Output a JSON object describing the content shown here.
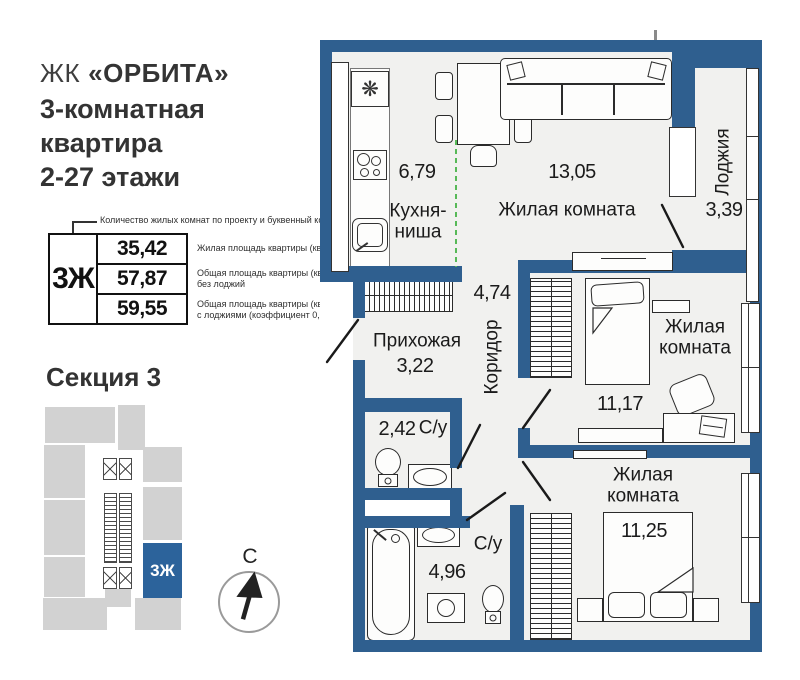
{
  "header": {
    "complex_prefix": "ЖК",
    "complex_name": "«ОРБИТА»",
    "apartment_title": "3-комнатная\nквартира\n2-27 этажи"
  },
  "info_table": {
    "callout": "Количество жилых комнат по проекту и буквенный код",
    "code": "3Ж",
    "rows": [
      {
        "value": "35,42",
        "desc": "Жилая площадь квартиры (кв.м)"
      },
      {
        "value": "57,87",
        "desc": "Общая площадь квартиры (кв.м)\nбез лоджий"
      },
      {
        "value": "59,55",
        "desc": "Общая площадь квартиры (кв.м)\nс лоджиями (коэффициент 0,5)"
      }
    ]
  },
  "section": {
    "title": "Секция 3",
    "highlight_label": "3Ж"
  },
  "compass": {
    "north_label": "С"
  },
  "plan": {
    "rooms": [
      {
        "name": "Кухня-\nниша",
        "area": "6,79"
      },
      {
        "name": "Жилая комната",
        "area": "13,05"
      },
      {
        "name": "Лоджия",
        "area": "3,39"
      },
      {
        "name": "Прихожая",
        "area": "3,22"
      },
      {
        "name": "Коридор",
        "area": "4,74"
      },
      {
        "name": "С/у",
        "area": "2,42"
      },
      {
        "name": "Жилая\nкомната",
        "area": "11,17"
      },
      {
        "name": "С/у",
        "area": "4,96"
      },
      {
        "name": "Жилая комната",
        "area": "11,25"
      }
    ]
  },
  "colors": {
    "wall": "#2f5f8f",
    "floor": "#f1f1ef",
    "accent_block": "#2c639b",
    "minimap_gray": "#d2d2d2",
    "divider_green": "#57b957"
  }
}
